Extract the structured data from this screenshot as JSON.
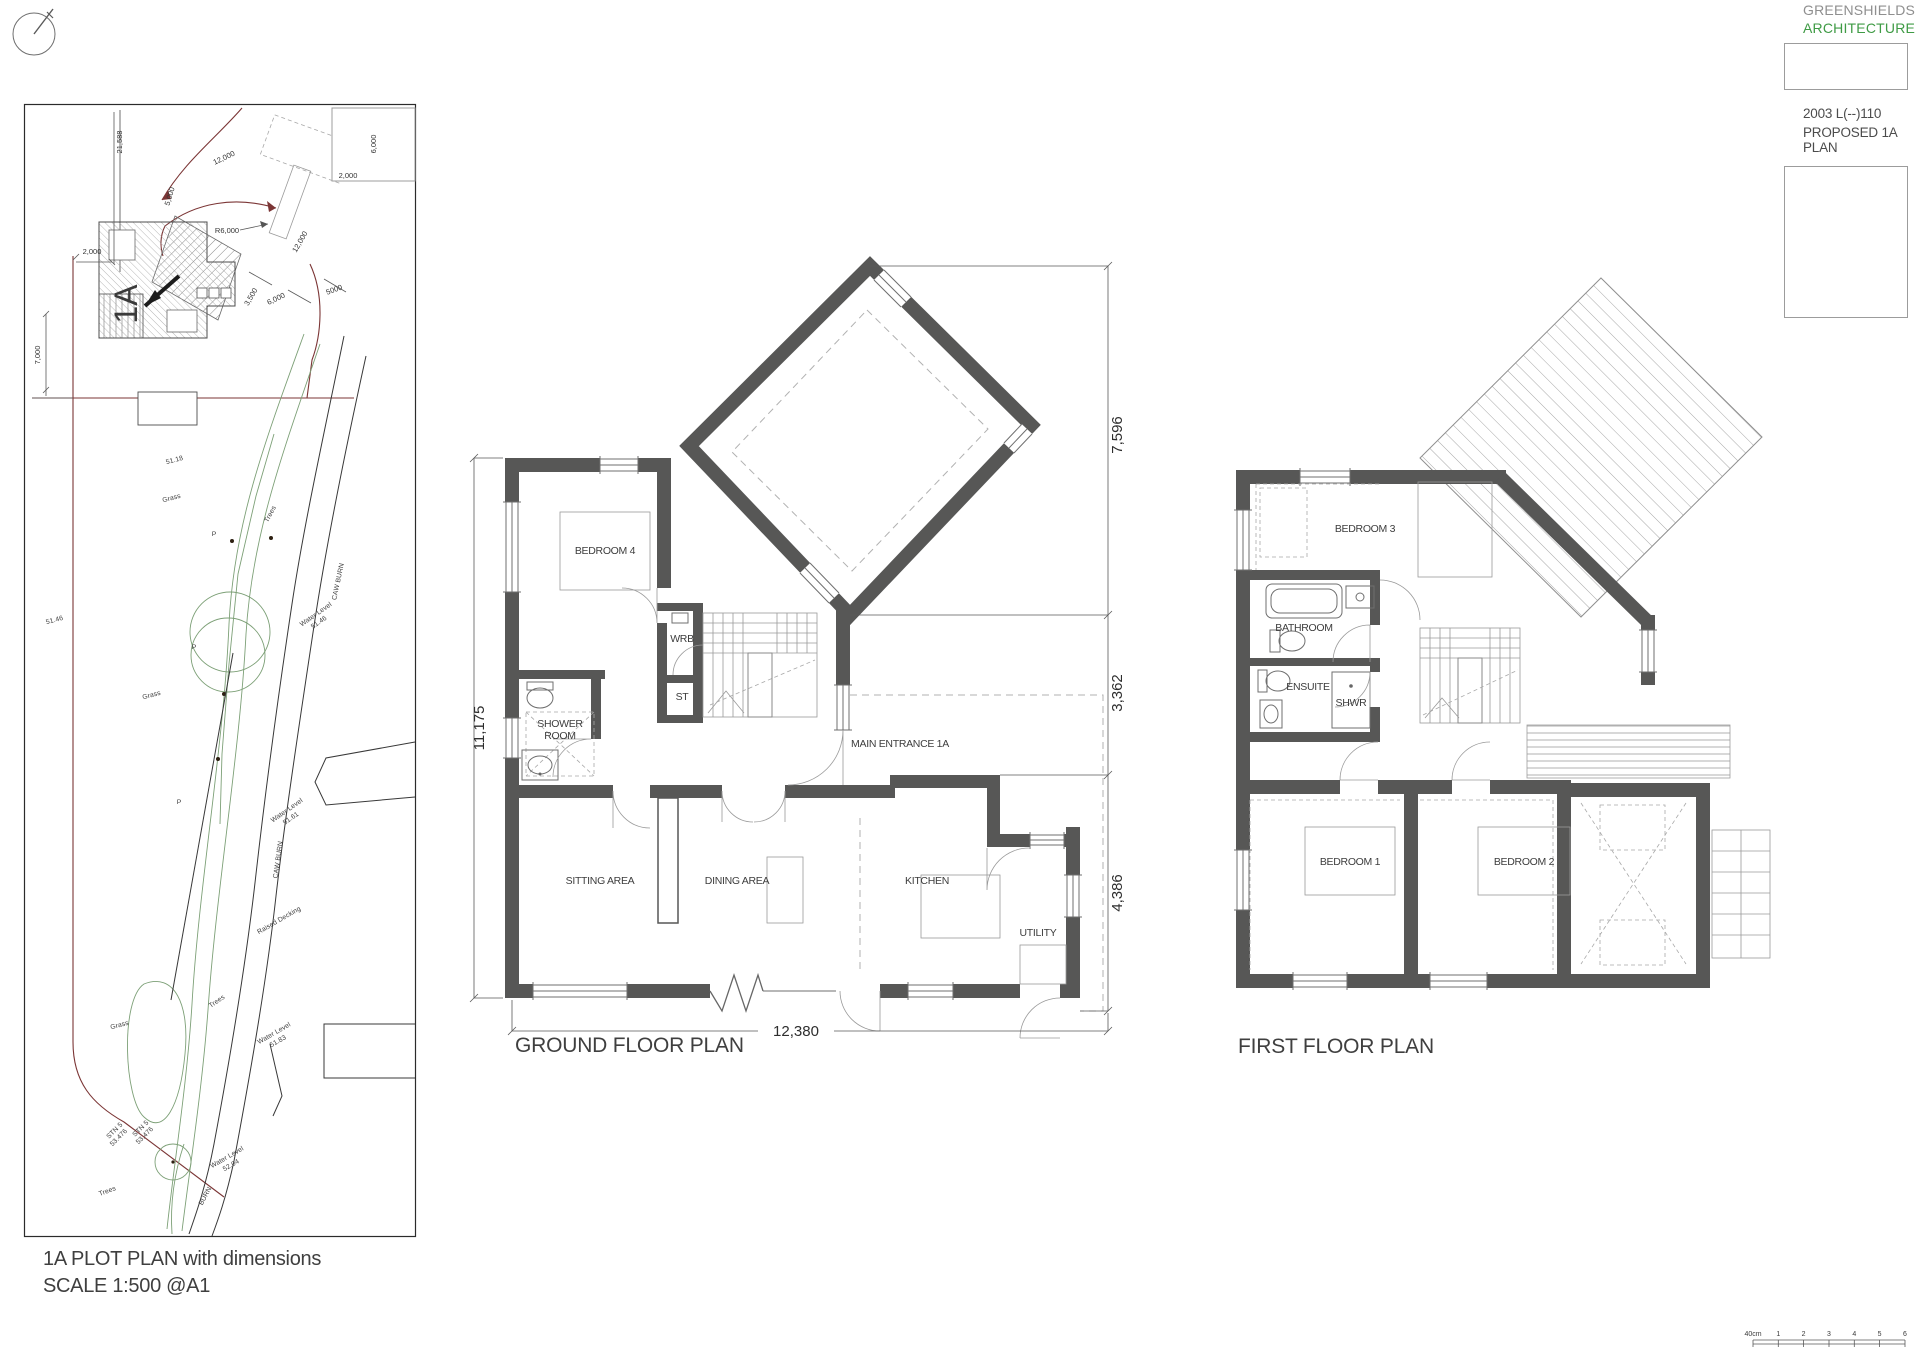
{
  "colors": {
    "wall": "#575756",
    "site_boundary": "#7b3535",
    "landscape_green": "#7da077",
    "brand_green": "#3f9b45"
  },
  "title_block": {
    "firm_line1": "GREENSHIELDS",
    "firm_line2": "ARCHITECTURE",
    "project_code": "2003 L(--)110",
    "drawing_title": "PROPOSED 1A PLAN"
  },
  "plot_plan": {
    "caption_line1": "1A PLOT PLAN with dimensions",
    "caption_line2": "SCALE 1:500 @A1",
    "house_label": "1A",
    "dims": {
      "boundary_left": "21,588",
      "road_length": "12,000",
      "road_width": "5,000",
      "corner_radius": "R6,000",
      "offset_west": "2,000",
      "offset_ne": "2,000",
      "visitor_bay": "6,000",
      "garden_depth": "7,000",
      "drive_width_a": "3,500",
      "drive_width_b": "6,000",
      "drive_length": "12,000",
      "frontage": "5000"
    },
    "labels": {
      "spot_level_upper": "51.18",
      "spot_level_west": "51.46",
      "grass_upper": "Grass",
      "grass_mid": "Grass",
      "grass_lower": "Grass",
      "trees_upper": "Trees",
      "trees_mid": "Trees",
      "trees_lower": "Trees",
      "caw_burn_upper": "CAW BURN",
      "caw_burn_mid": "CAW BURN",
      "burn_lower": "BURN",
      "water_level_label": "Water Level",
      "water_level_value_1": "51.46",
      "water_level_value_2": "51.61",
      "water_level_value_3": "51.83",
      "water_level_value_4": "52.04",
      "raised_decking": "Raised Decking",
      "stn_label": "STN 5",
      "stn_value": "53.476",
      "point_marker": "P"
    }
  },
  "ground_floor": {
    "caption": "GROUND FLOOR PLAN",
    "rooms": {
      "bedroom4": "BEDROOM 4",
      "wrb": "WRB",
      "st": "ST",
      "shower_line1": "SHOWER",
      "shower_line2": "ROOM",
      "main_entrance": "MAIN ENTRANCE 1A",
      "sitting": "SITTING AREA",
      "dining": "DINING AREA",
      "kitchen": "KITCHEN",
      "utility": "UTILITY"
    },
    "dims": {
      "left_height": "11,175",
      "right_top": "7,596",
      "right_mid": "3,362",
      "right_bottom": "4,386",
      "bottom_width": "12,380"
    }
  },
  "first_floor": {
    "caption": "FIRST FLOOR PLAN",
    "rooms": {
      "bedroom3": "BEDROOM 3",
      "bathroom": "BATHROOM",
      "ensuite": "ENSUITE",
      "shower_abbr": "SHWR",
      "bedroom1": "BEDROOM 1",
      "bedroom2": "BEDROOM 2"
    }
  },
  "scale_bar": {
    "origin": "40cm",
    "ticks": [
      "1",
      "2",
      "3",
      "4",
      "5",
      "6"
    ]
  }
}
